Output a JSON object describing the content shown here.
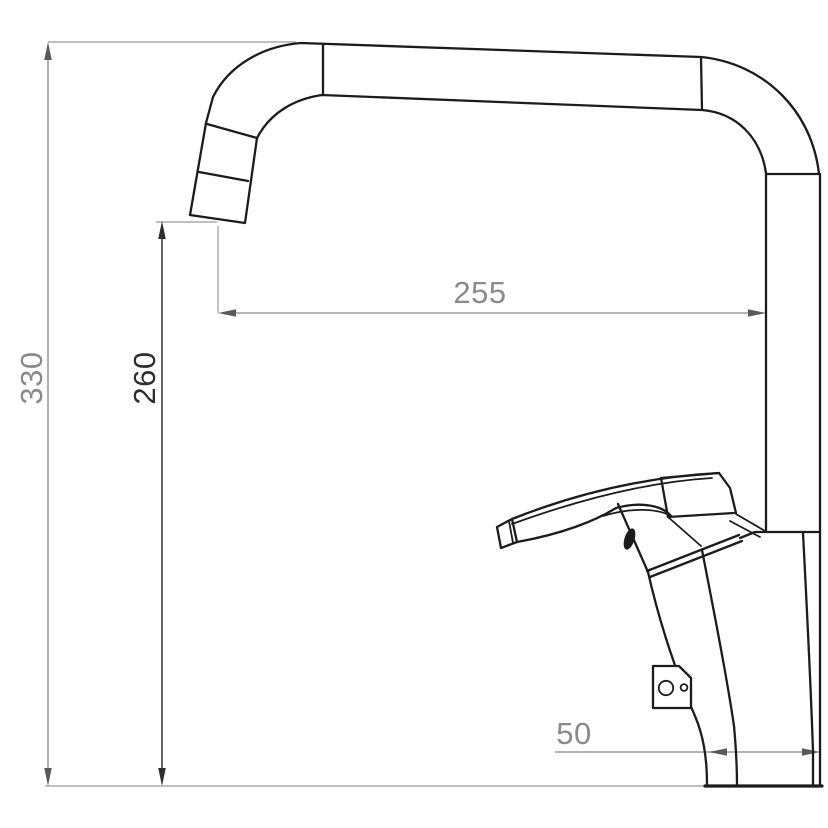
{
  "diagram": {
    "type": "technical-dimension-drawing",
    "subject": "single-lever kitchen faucet, side elevation",
    "dimensions": {
      "overall_height": {
        "label": "330",
        "orientation": "vertical"
      },
      "spout_clearance_height": {
        "label": "260",
        "orientation": "vertical"
      },
      "spout_reach": {
        "label": "255",
        "orientation": "horizontal"
      },
      "base_depth": {
        "label": "50",
        "orientation": "horizontal"
      }
    },
    "colors": {
      "outline": "#1c1c1c",
      "dimension_line": "#9c9c9c",
      "dimension_line_dark": "#4a4a4a",
      "extension_line": "#ababab",
      "label_gray": "#8a8a8a",
      "label_dark": "#2e2e2e",
      "background": "#ffffff"
    }
  }
}
